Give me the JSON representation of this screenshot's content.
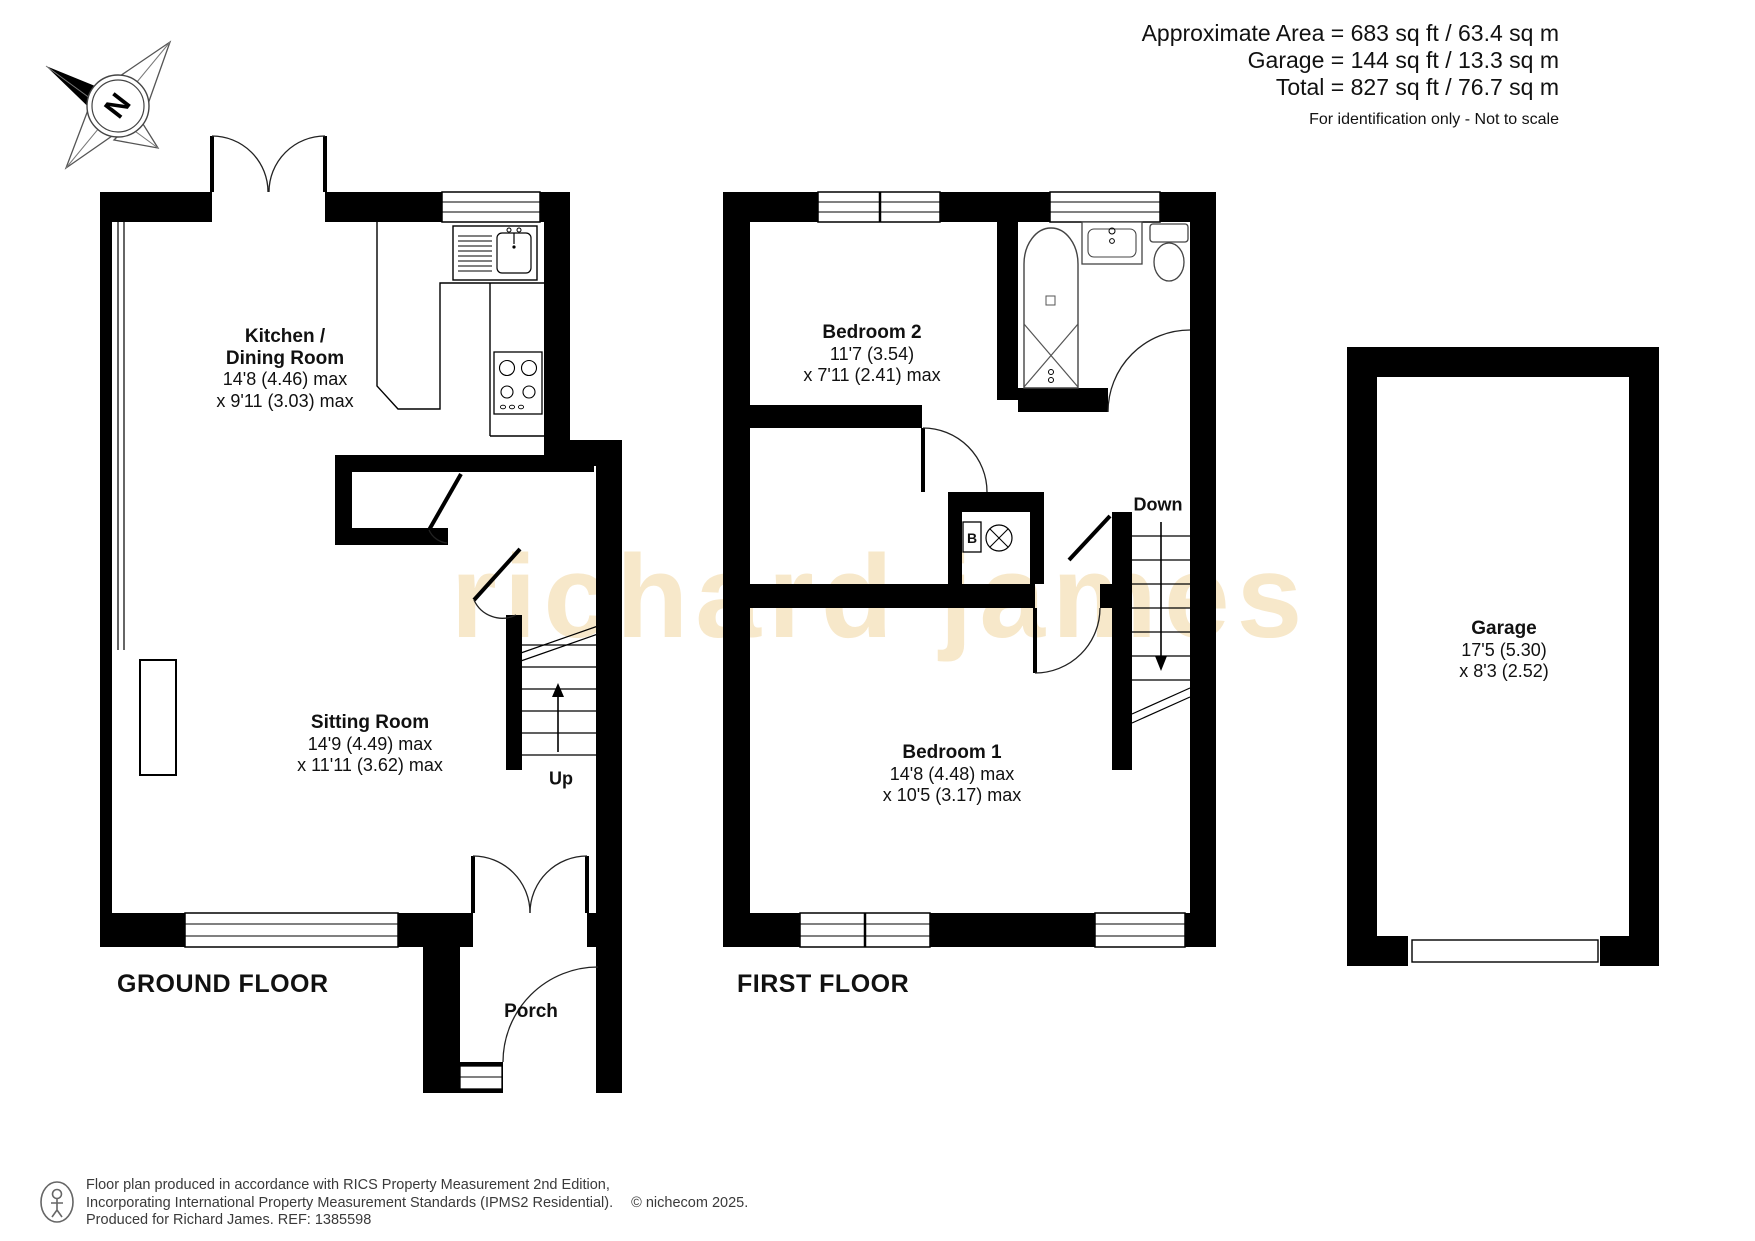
{
  "header": {
    "area_line1": "Approximate Area = 683 sq ft / 63.4 sq m",
    "area_line2": "Garage = 144 sq ft / 13.3 sq m",
    "area_line3": "Total = 827 sq ft / 76.7 sq m",
    "disclaimer": "For identification only - Not to scale"
  },
  "compass": {
    "label": "N"
  },
  "watermark": {
    "text": "richard james",
    "color": "#f7e8ca"
  },
  "floors": {
    "ground": {
      "caption": "GROUND FLOOR",
      "rooms": {
        "kitchen": {
          "name_line1": "Kitchen /",
          "name_line2": "Dining Room",
          "dim1": "14'8 (4.46) max",
          "dim2": "x 9'11 (3.03) max"
        },
        "sitting": {
          "name": "Sitting Room",
          "dim1": "14'9 (4.49) max",
          "dim2": "x 11'11 (3.62) max"
        },
        "porch": {
          "name": "Porch"
        }
      },
      "stairs_label": "Up"
    },
    "first": {
      "caption": "FIRST FLOOR",
      "rooms": {
        "bedroom2": {
          "name": "Bedroom 2",
          "dim1": "11'7 (3.54)",
          "dim2": "x 7'11 (2.41) max"
        },
        "bedroom1": {
          "name": "Bedroom 1",
          "dim1": "14'8 (4.48) max",
          "dim2": "x 10'5 (3.17) max"
        }
      },
      "stairs_label": "Down",
      "boiler_label": "B"
    },
    "garage": {
      "rooms": {
        "garage": {
          "name": "Garage",
          "dim1": "17'5 (5.30)",
          "dim2": "x 8'3 (2.52)"
        }
      }
    }
  },
  "footer": {
    "line1": "Floor plan produced in accordance with RICS Property Measurement 2nd Edition,",
    "line2": "Incorporating International Property Measurement Standards (IPMS2 Residential).",
    "copyright": "© nichecom 2025.",
    "line3": "Produced for Richard James.   REF:  1385598"
  }
}
